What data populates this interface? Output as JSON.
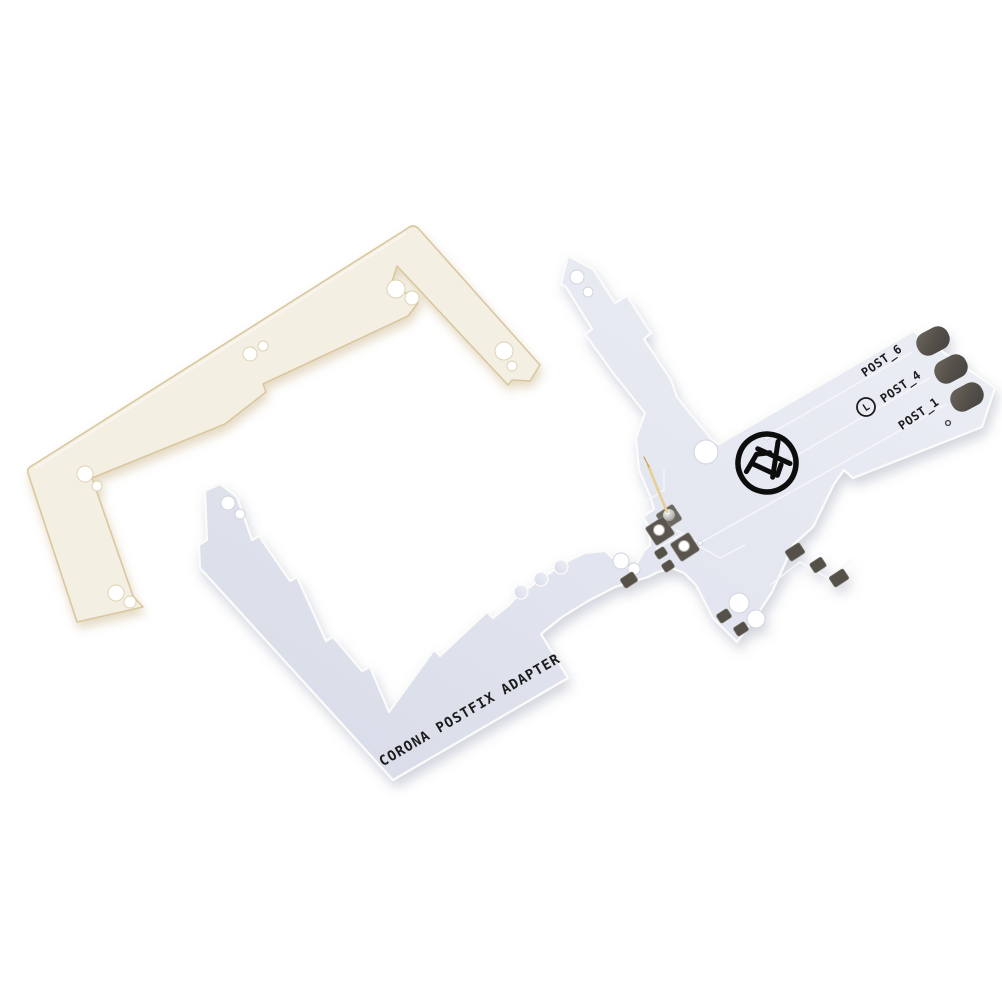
{
  "photo": {
    "background_color": "#ffffff",
    "white_pcb": {
      "name": "corona-postfix-adapter-board",
      "silkscreen_text": "CORONA POSTFIX ADAPTER",
      "post_labels": [
        "POST_6",
        "POST_4",
        "POST_1"
      ],
      "l_mark": "L",
      "logo_text": "TX",
      "board_color": "#e3e6ef",
      "edge_highlight_color": "#fbfbfa",
      "silkscreen_color": "#1d1d1d",
      "pad_color": "#55514a",
      "pin_color": "#c29a45"
    },
    "cream_frame": {
      "name": "cream-spacer-frame",
      "color": "#f3efe3",
      "edge_color": "#dac79e"
    }
  }
}
